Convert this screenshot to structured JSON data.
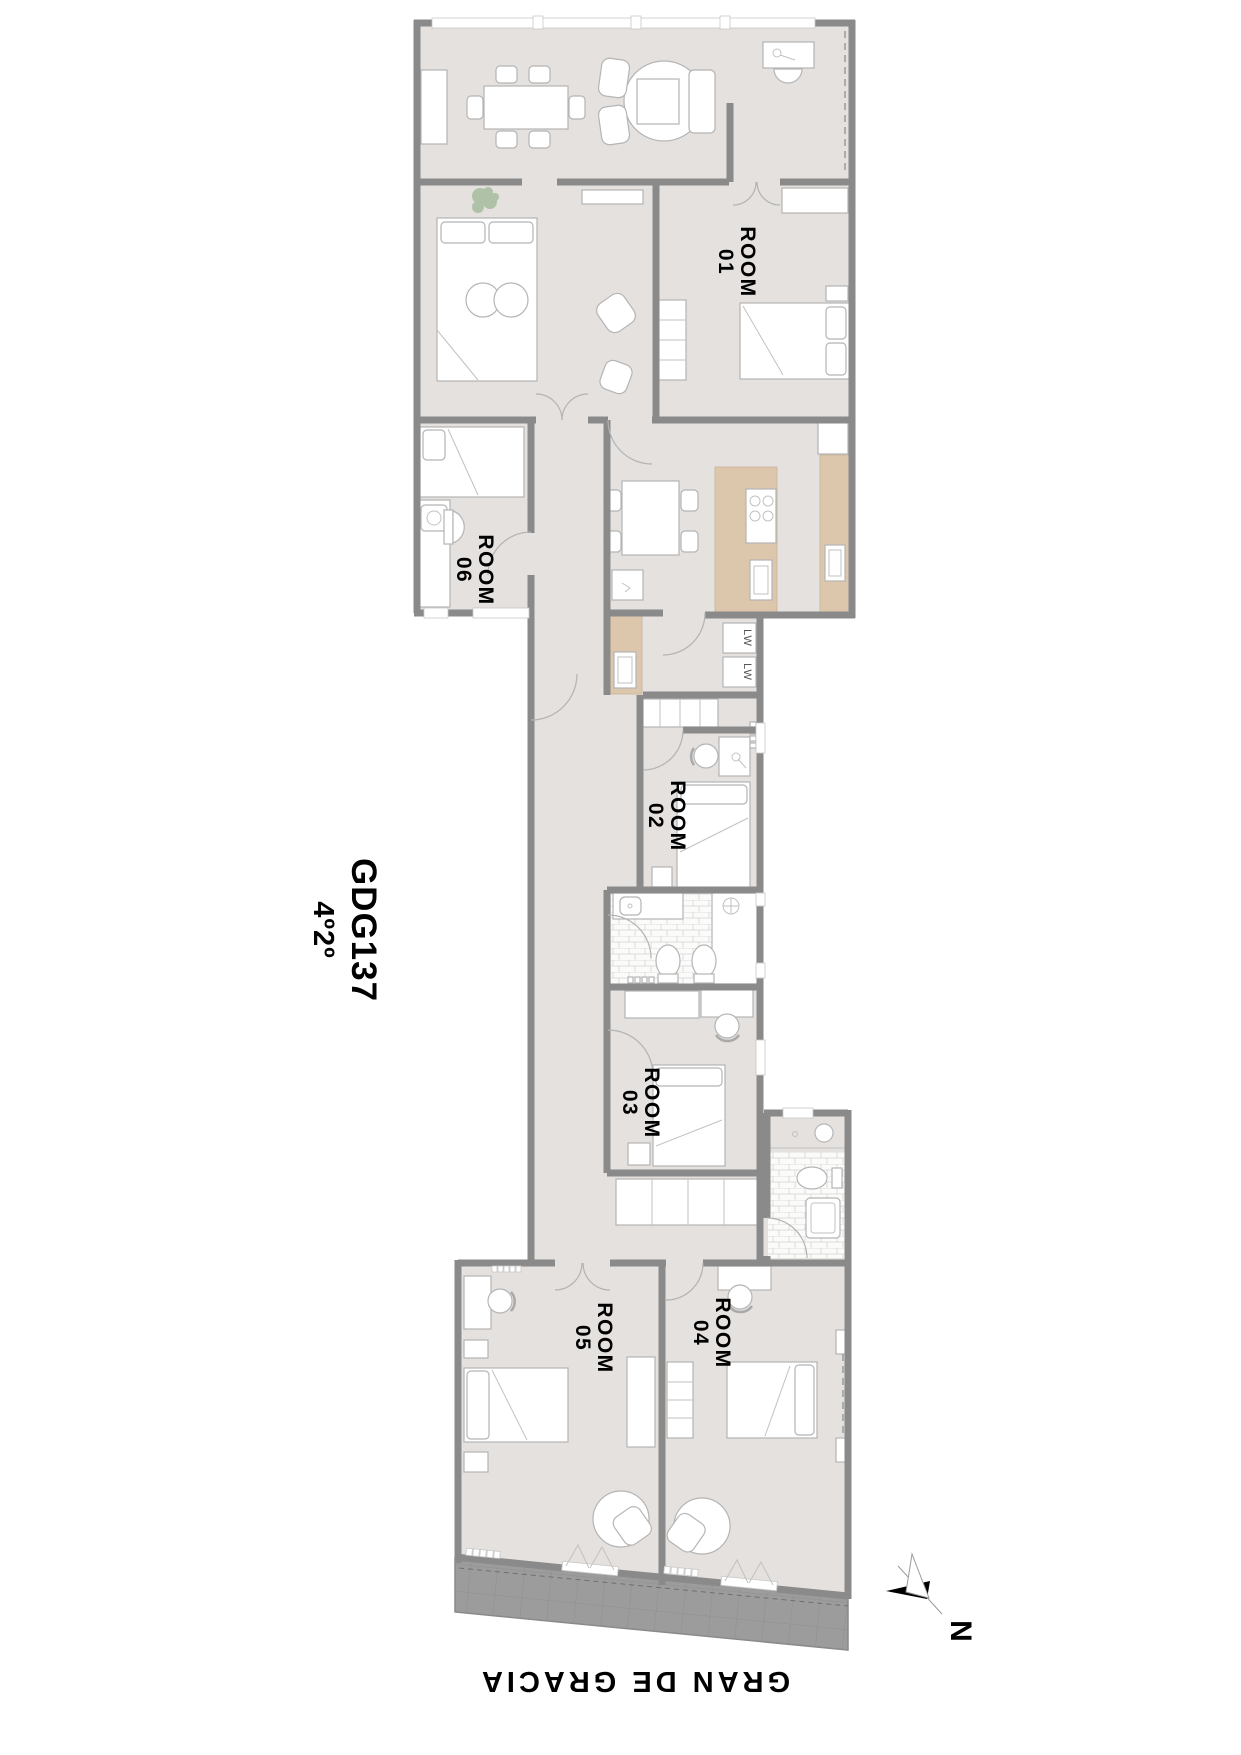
{
  "title": {
    "project_code": "GDG137",
    "unit": "4º2º"
  },
  "street": {
    "name": "GRAN DE GRACIA"
  },
  "compass": {
    "north_label": "N"
  },
  "rooms": [
    {
      "id": "room-01",
      "name_line": "ROOM",
      "number_line": "01"
    },
    {
      "id": "room-02",
      "name_line": "ROOM",
      "number_line": "02"
    },
    {
      "id": "room-03",
      "name_line": "ROOM",
      "number_line": "03"
    },
    {
      "id": "room-04",
      "name_line": "ROOM",
      "number_line": "04"
    },
    {
      "id": "room-05",
      "name_line": "ROOM",
      "number_line": "05"
    },
    {
      "id": "room-06",
      "name_line": "ROOM",
      "number_line": "06"
    }
  ],
  "appliances": {
    "washer_1": "LW",
    "washer_2": "LW"
  },
  "colors": {
    "background": "#ffffff",
    "floor": "#e4e1de",
    "wall": "#8a8a8a",
    "counter": "#dcc7ad",
    "facade": "#9c9c9c",
    "furniture_stroke": "#b5b5b5",
    "text": "#000000",
    "plant": "#a6bd9e"
  }
}
